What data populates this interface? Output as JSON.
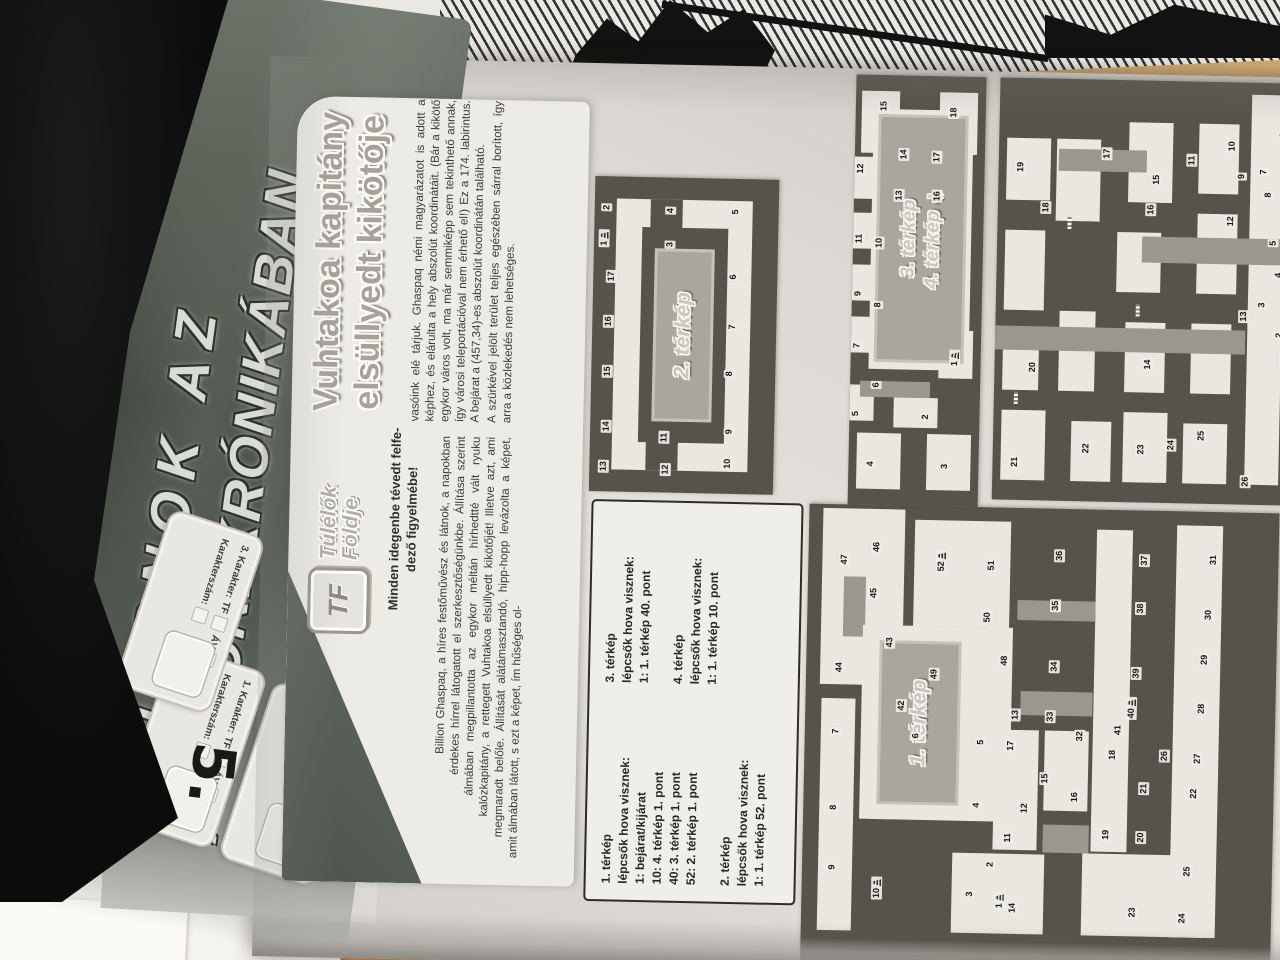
{
  "scene": {
    "handwritten_mark": "5."
  },
  "page": {
    "banner": {
      "line1": "KUPONOK AZ",
      "line2": "ALANORI KRÓNIKÁBAN"
    },
    "coupons": [
      {
        "label": "1. Karakter:",
        "field1": "TF",
        "field2": "ÁV",
        "row2_label": "Karakterszám:"
      },
      {
        "label": "2. Karakter:",
        "field1": "TF",
        "field2": "ÁV",
        "row2_label": "Karakterszám:"
      },
      {
        "label": "3. Karakter:",
        "field1": "TF",
        "field2": "ÁV",
        "row2_label": "Karakterszám:"
      }
    ],
    "logo": {
      "badge": "TF",
      "name_line1": "Túlélők",
      "name_line2": "Földje"
    },
    "title": {
      "line1": "Vuhtakoa kapitány",
      "line2": "elsüllyedt kikötője"
    },
    "notice": {
      "line1": "Minden idegenbe tévedt felfe-",
      "line2": "dező figyelmébe!"
    },
    "article": {
      "col1": "Billion Ghaspaq, a híres festőművész és látnok, a napokban érdekes hírrel látogatott el szerkesztőségünkbe. Állítása szerint álmában megpillantotta az egykor méltán hírhedtté vált ryuku kalózkapitány, a rettegett Vuhtakoa elsüllyedt kikötőjét! Illetve azt, ami megmaradt belőle. Állítását alátámasztandó, hipp-hopp levázolta a képet, amit álmában látott, s ezt a képet, ím hűséges ol-",
      "col2_p1": "vasóink elé tárjuk. Ghaspaq némi magyarázatot is adott a képhez, és elárulta a hely abszolút koordinátáit. (Bár a kikötő egykor város volt, ma már semmiképp sem tekinthető annak, így városi teleportációval nem érhető el!) Ez a 174. labirintus. A bejárat a (457,34)-es abszolút koordinátán található.",
      "col2_p2": "A szürkével jelölt terület teljes egészében sárral borított, így arra a közlekedés nem lehetséges."
    },
    "legend": {
      "col1": [
        "1. térkép",
        "lépcsők hova visznek:",
        "1: bejárat/kijárat",
        "10: 4. térkép 1. pont",
        "40: 3. térkép 1. pont",
        "52: 2. térkép 1. pont",
        "",
        "2. térkép",
        "lépcsők hova visznek:",
        "1: 1. térkép 52. pont"
      ],
      "col2": [
        "3. térkép",
        "lépcsők hova visznek:",
        "1: 1. térkép 40. pont",
        "",
        "4. térkép",
        "lépcsők hova visznek:",
        "1: 1. térkép 10. pont"
      ]
    },
    "maps": [
      {
        "id": "map1",
        "label": "1. térkép",
        "points": [
          [
            1,
            69,
            198,
            1
          ],
          [
            2,
            105,
            188
          ],
          [
            3,
            75,
            168
          ],
          [
            4,
            164,
            173
          ],
          [
            5,
            227,
            176
          ],
          [
            6,
            232,
            111
          ],
          [
            7,
            235,
            31
          ],
          [
            8,
            159,
            30
          ],
          [
            9,
            99,
            30
          ],
          [
            10,
            79,
            75,
            1
          ],
          [
            11,
            132,
            205
          ],
          [
            12,
            162,
            221
          ],
          [
            13,
            255,
            210
          ],
          [
            14,
            62,
            211
          ],
          [
            15,
            192,
            241
          ],
          [
            16,
            174,
            271
          ],
          [
            17,
            224,
            206
          ],
          [
            18,
            217,
            308
          ],
          [
            19,
            137,
            303
          ],
          [
            20,
            135,
            338
          ],
          [
            21,
            184,
            340
          ],
          [
            22,
            180,
            390
          ],
          [
            23,
            60,
            331
          ],
          [
            24,
            55,
            381
          ],
          [
            25,
            102,
            385
          ],
          [
            26,
            217,
            360
          ],
          [
            27,
            215,
            393
          ],
          [
            28,
            265,
            396
          ],
          [
            29,
            314,
            398
          ],
          [
            30,
            359,
            401
          ],
          [
            31,
            414,
            405
          ],
          [
            32,
            235,
            275
          ],
          [
            33,
            254,
            245
          ],
          [
            34,
            304,
            248
          ],
          [
            35,
            365,
            248
          ],
          [
            36,
            415,
            251
          ],
          [
            37,
            412,
            336
          ],
          [
            38,
            364,
            333
          ],
          [
            39,
            299,
            330
          ],
          [
            40,
            264,
            326,
            1
          ],
          [
            41,
            242,
            313
          ],
          [
            42,
            262,
            96
          ],
          [
            43,
            325,
            83
          ],
          [
            44,
            299,
            33
          ],
          [
            45,
            374,
            66
          ],
          [
            46,
            420,
            68
          ],
          [
            47,
            407,
            36
          ],
          [
            48,
            309,
            198
          ],
          [
            49,
            294,
            128
          ],
          [
            50,
            352,
            180
          ],
          [
            51,
            404,
            183
          ],
          [
            52,
            407,
            133,
            1
          ]
        ]
      },
      {
        "id": "map2",
        "label": "2. térkép",
        "points": [
          [
            1,
            253,
            14,
            1
          ],
          [
            2,
            284,
            16
          ],
          [
            3,
            248,
            80
          ],
          [
            4,
            282,
            80
          ],
          [
            5,
            282,
            145
          ],
          [
            6,
            217,
            144
          ],
          [
            7,
            167,
            144
          ],
          [
            8,
            120,
            142
          ],
          [
            9,
            62,
            143
          ],
          [
            10,
            30,
            142
          ],
          [
            11,
            55,
            78
          ],
          [
            12,
            23,
            80
          ],
          [
            13,
            25,
            18
          ],
          [
            14,
            65,
            20
          ],
          [
            15,
            120,
            20
          ],
          [
            16,
            170,
            20
          ],
          [
            17,
            215,
            22
          ]
        ]
      },
      {
        "id": "map3",
        "label": "3. térkép",
        "label2": "4. térkép",
        "arrow": "➔",
        "points": [
          [
            1,
            148,
            104,
            1
          ],
          [
            2,
            89,
            76
          ],
          [
            3,
            40,
            96
          ],
          [
            4,
            41,
            22
          ],
          [
            5,
            91,
            6
          ],
          [
            6,
            120,
            26
          ],
          [
            7,
            159,
            6
          ],
          [
            8,
            200,
            26
          ],
          [
            9,
            211,
            6
          ],
          [
            10,
            262,
            26
          ],
          [
            11,
            266,
            6
          ],
          [
            12,
            336,
            6
          ],
          [
            13,
            310,
            45
          ],
          [
            14,
            351,
            49
          ],
          [
            15,
            399,
            28
          ],
          [
            16,
            310,
            83
          ],
          [
            17,
            349,
            82
          ],
          [
            18,
            394,
            98
          ]
        ]
      },
      {
        "id": "map4",
        "label": null,
        "points": [
          [
            1,
            146,
            290,
            1
          ],
          [
            2,
            170,
            284
          ],
          [
            3,
            200,
            266
          ],
          [
            4,
            230,
            282
          ],
          [
            5,
            262,
            276
          ],
          [
            6,
            370,
            284
          ],
          [
            7,
            333,
            265
          ],
          [
            8,
            310,
            270
          ],
          [
            9,
            328,
            243
          ],
          [
            10,
            358,
            233
          ],
          [
            11,
            343,
            193
          ],
          [
            12,
            283,
            233
          ],
          [
            13,
            188,
            248
          ],
          [
            14,
            138,
            153
          ],
          [
            15,
            323,
            158
          ],
          [
            16,
            293,
            153
          ],
          [
            17,
            348,
            108
          ],
          [
            18,
            293,
            48
          ],
          [
            19,
            333,
            22
          ],
          [
            20,
            133,
            38
          ],
          [
            21,
            38,
            22
          ],
          [
            22,
            53,
            93
          ],
          [
            23,
            53,
            148
          ],
          [
            24,
            58,
            178
          ],
          [
            25,
            68,
            208
          ],
          [
            26,
            23,
            253
          ]
        ]
      }
    ]
  }
}
